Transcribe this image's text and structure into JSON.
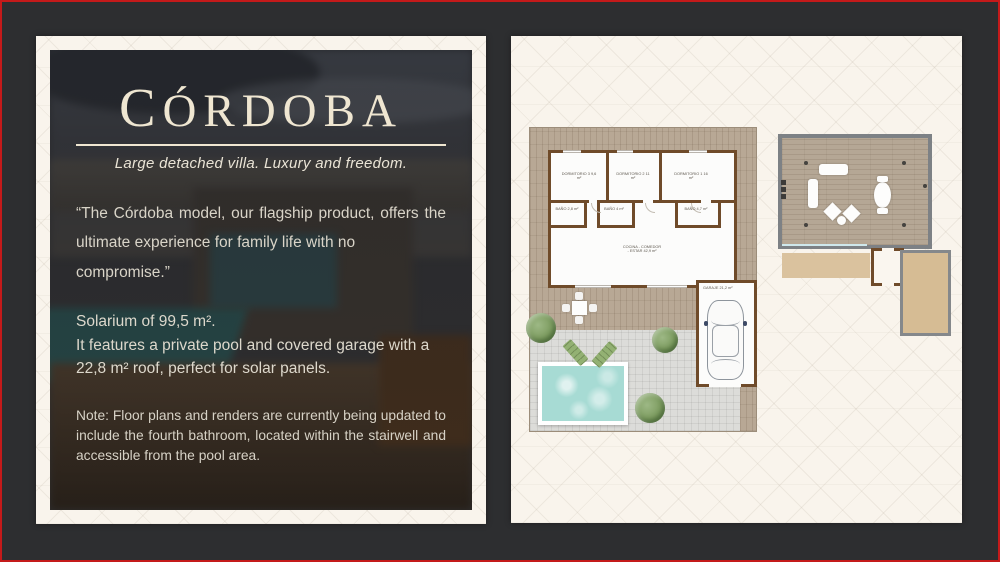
{
  "left_panel": {
    "title": "Córdoba",
    "subtitle": "Large detached villa. Luxury and freedom.",
    "quote_lines": [
      "“The Córdoba model, our flagship product, offers the",
      "ultimate experience for family life with no compromise.”"
    ],
    "spec_lines": [
      "Solarium of 99,5 m².",
      "It features a private pool and covered garage with a",
      "22,8 m² roof, perfect for solar panels."
    ],
    "note_lines": [
      "Note: Floor plans and renders are currently being updated to",
      "include the fourth bathroom, located within the stairwell and",
      "accessible from the pool area."
    ]
  },
  "floor_plan": {
    "rooms": [
      {
        "name": "DORMITORIO 3",
        "area": "9,6 m²"
      },
      {
        "name": "DORMITORIO 2",
        "area": "11 m²"
      },
      {
        "name": "DORMITORIO 1",
        "area": "16 m²"
      },
      {
        "name": "BAÑO",
        "area": "2,8 m²"
      },
      {
        "name": "BAÑO",
        "area": "4 m²"
      },
      {
        "name": "BAÑO",
        "area": "4,7 m²"
      },
      {
        "name": "COCINA - COMEDOR - ESTAR",
        "area": "42,9 m²"
      },
      {
        "name": "GARAJE",
        "area": "21,2 m²"
      }
    ]
  },
  "colors": {
    "frame_red": "#c41a1a",
    "frame_charcoal": "#2d2e30",
    "panel_cream": "#f9f4ec",
    "title_cream": "#efe6d1",
    "wall_brown": "#6f4b2a",
    "deck_wood": "#b8a895",
    "pool_aqua": "#a7dbd4",
    "greenery": "#7d9c60"
  }
}
